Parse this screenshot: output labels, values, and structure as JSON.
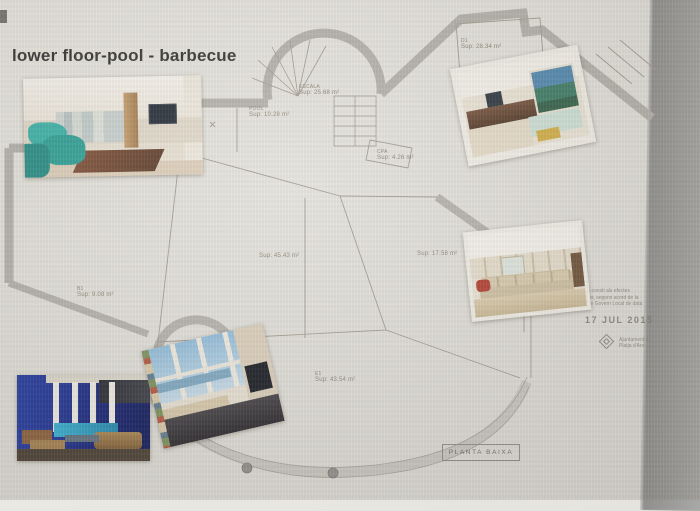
{
  "window": {
    "title": "lower floor-pool - barbecue"
  },
  "plan": {
    "labels": [
      {
        "l1": "POOL",
        "l2": "Sup: 10.28 m²"
      },
      {
        "l1": "ESCALA",
        "l2": "Sup: 25.68 m²"
      },
      {
        "l1": "D1",
        "l2": "Sup: 28.34 m²"
      },
      {
        "l1": "CPA",
        "l2": "Sup: 4.26 m²"
      },
      {
        "l1": "",
        "l2": "Sup: 45.43 m²"
      },
      {
        "l1": "",
        "l2": "Sup: 17.58 m²"
      },
      {
        "l1": "B1",
        "l2": "Sup: 9.08 m²"
      },
      {
        "l1": "E1",
        "l2": "Sup: 43.54 m²"
      }
    ],
    "title_box": "PLANTA BAIXA"
  },
  "stamp": {
    "line1": "Perquè consti als efectes",
    "line2": "oportuns, segons acord de la",
    "line3": "Junta de Govern Local de data",
    "date": "17 JUL 2015",
    "org1": "Ajuntament de",
    "org2": "Platja d'Aro"
  },
  "photos": [
    {
      "name": "living-room-photo"
    },
    {
      "name": "lounge-photo"
    },
    {
      "name": "bedroom-photo"
    },
    {
      "name": "indoor-pool-photo"
    },
    {
      "name": "sea-view-room-photo"
    }
  ],
  "colors": {
    "paper": "#e6e4de",
    "wall_gray": "#b4b1ab",
    "bezel_gray": "#9a9a98",
    "accent_teal": "#2fada3",
    "pool_blue": "#16309b",
    "sky_blue": "#9cc3de"
  }
}
